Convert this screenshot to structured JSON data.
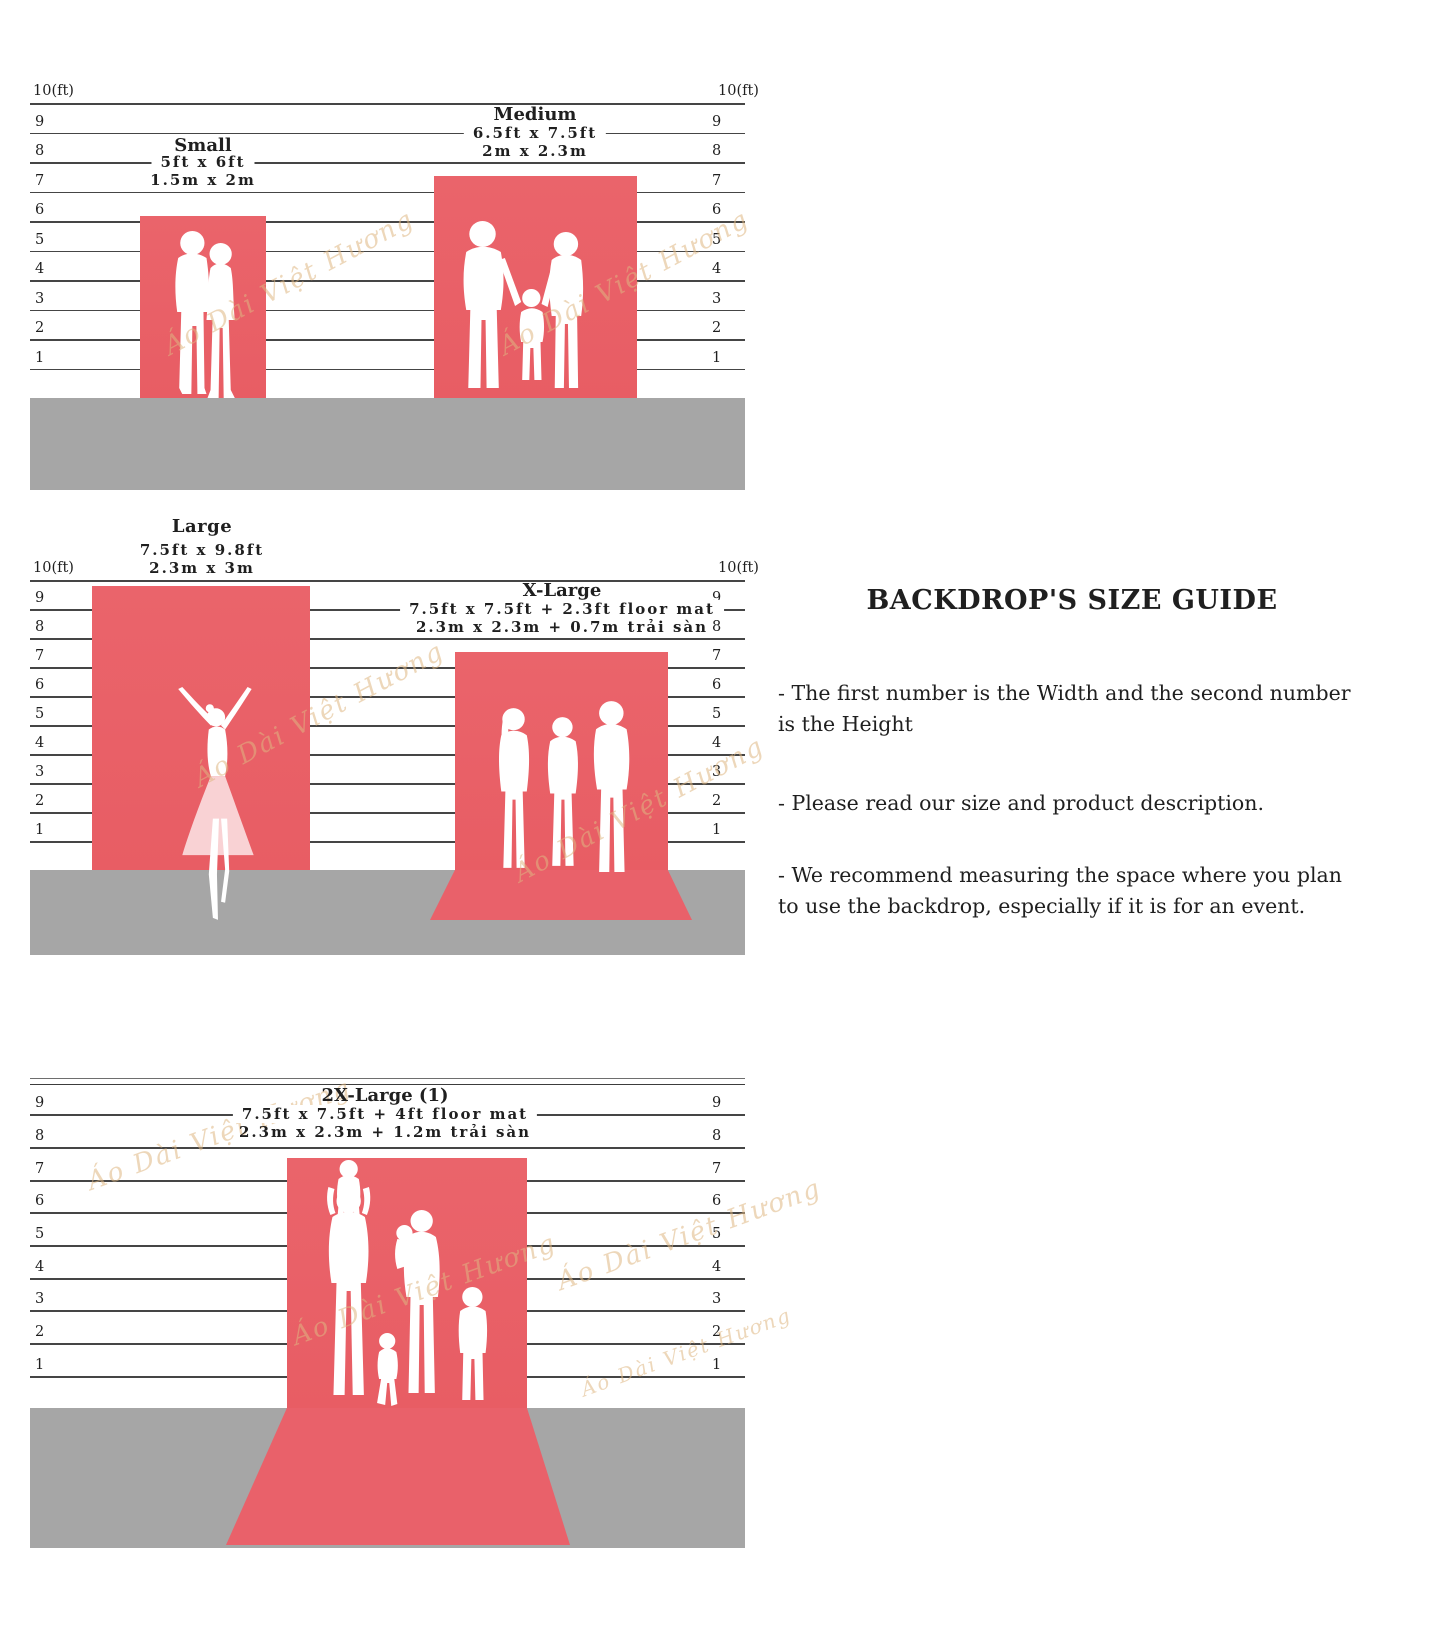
{
  "watermark": {
    "text": "Áo Dài Việt Hương"
  },
  "colors": {
    "backdrop_red": "#e95f66",
    "floor_gray": "#a6a6a6",
    "ruler_line": "#454545",
    "text_dark": "#1f1f1f",
    "watermark_tan": "#deb682"
  },
  "rulers": {
    "top_label": "10(ft)",
    "ticks": [
      "9",
      "8",
      "7",
      "6",
      "5",
      "4",
      "3",
      "2",
      "1"
    ]
  },
  "sizes": {
    "small": {
      "name": "Small",
      "imperial": "5ft x 6ft",
      "metric": "1.5m x 2m"
    },
    "medium": {
      "name": "Medium",
      "imperial": "6.5ft x 7.5ft",
      "metric": "2m x 2.3m"
    },
    "large": {
      "name": "Large",
      "imperial": "7.5ft x 9.8ft",
      "metric": "2.3m x 3m"
    },
    "xlarge": {
      "name": "X-Large",
      "imperial": "7.5ft x 7.5ft + 2.3ft floor mat",
      "metric": "2.3m x 2.3m + 0.7m trải sàn"
    },
    "xxlarge": {
      "name": "2X-Large (1)",
      "imperial": "7.5ft x 7.5ft + 4ft floor mat",
      "metric": "2.3m x 2.3m + 1.2m trải sàn"
    }
  },
  "info_panel": {
    "title": "BACKDROP'S SIZE GUIDE",
    "bullets": [
      "-  The first number is the Width and the second number is the Height",
      "- Please read our size and product description.",
      "- We recommend measuring the space where you plan to use the backdrop, especially if it is for an event."
    ]
  }
}
